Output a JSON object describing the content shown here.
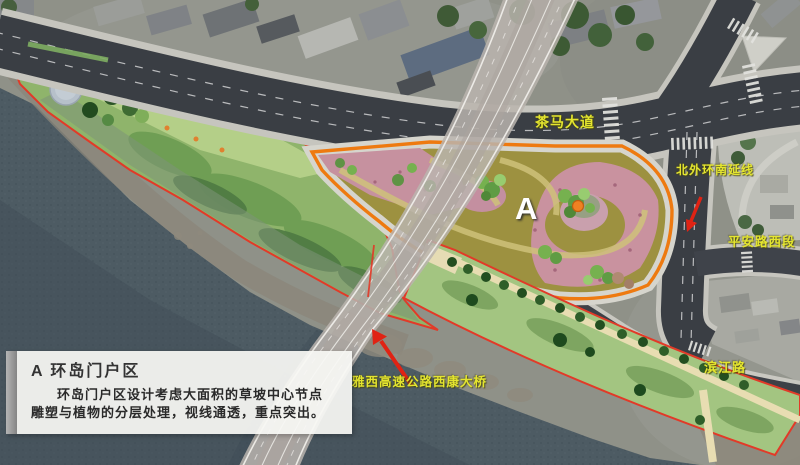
{
  "map": {
    "road_labels": {
      "chama": "茶马大道",
      "beiwaihuan": "北外环南延线",
      "pingan": "平安路西段",
      "binjiang": "滨江路",
      "bridge": "雅西高速公路西康大桥"
    },
    "zone_marker": "A"
  },
  "info_box": {
    "title": "A 环岛门户区",
    "body_lines": [
      "环岛门户区设计考虑大面积的草坡中心节点",
      "雕塑与植物的分层处理，视线通透，重点突出。"
    ]
  },
  "colors": {
    "label_yellow": "#e4e52f",
    "outline_red": "#e23a28",
    "zone_orange": "#ee7a10",
    "water": "#4d5b63",
    "bridge_gray": "#bab4ae"
  }
}
